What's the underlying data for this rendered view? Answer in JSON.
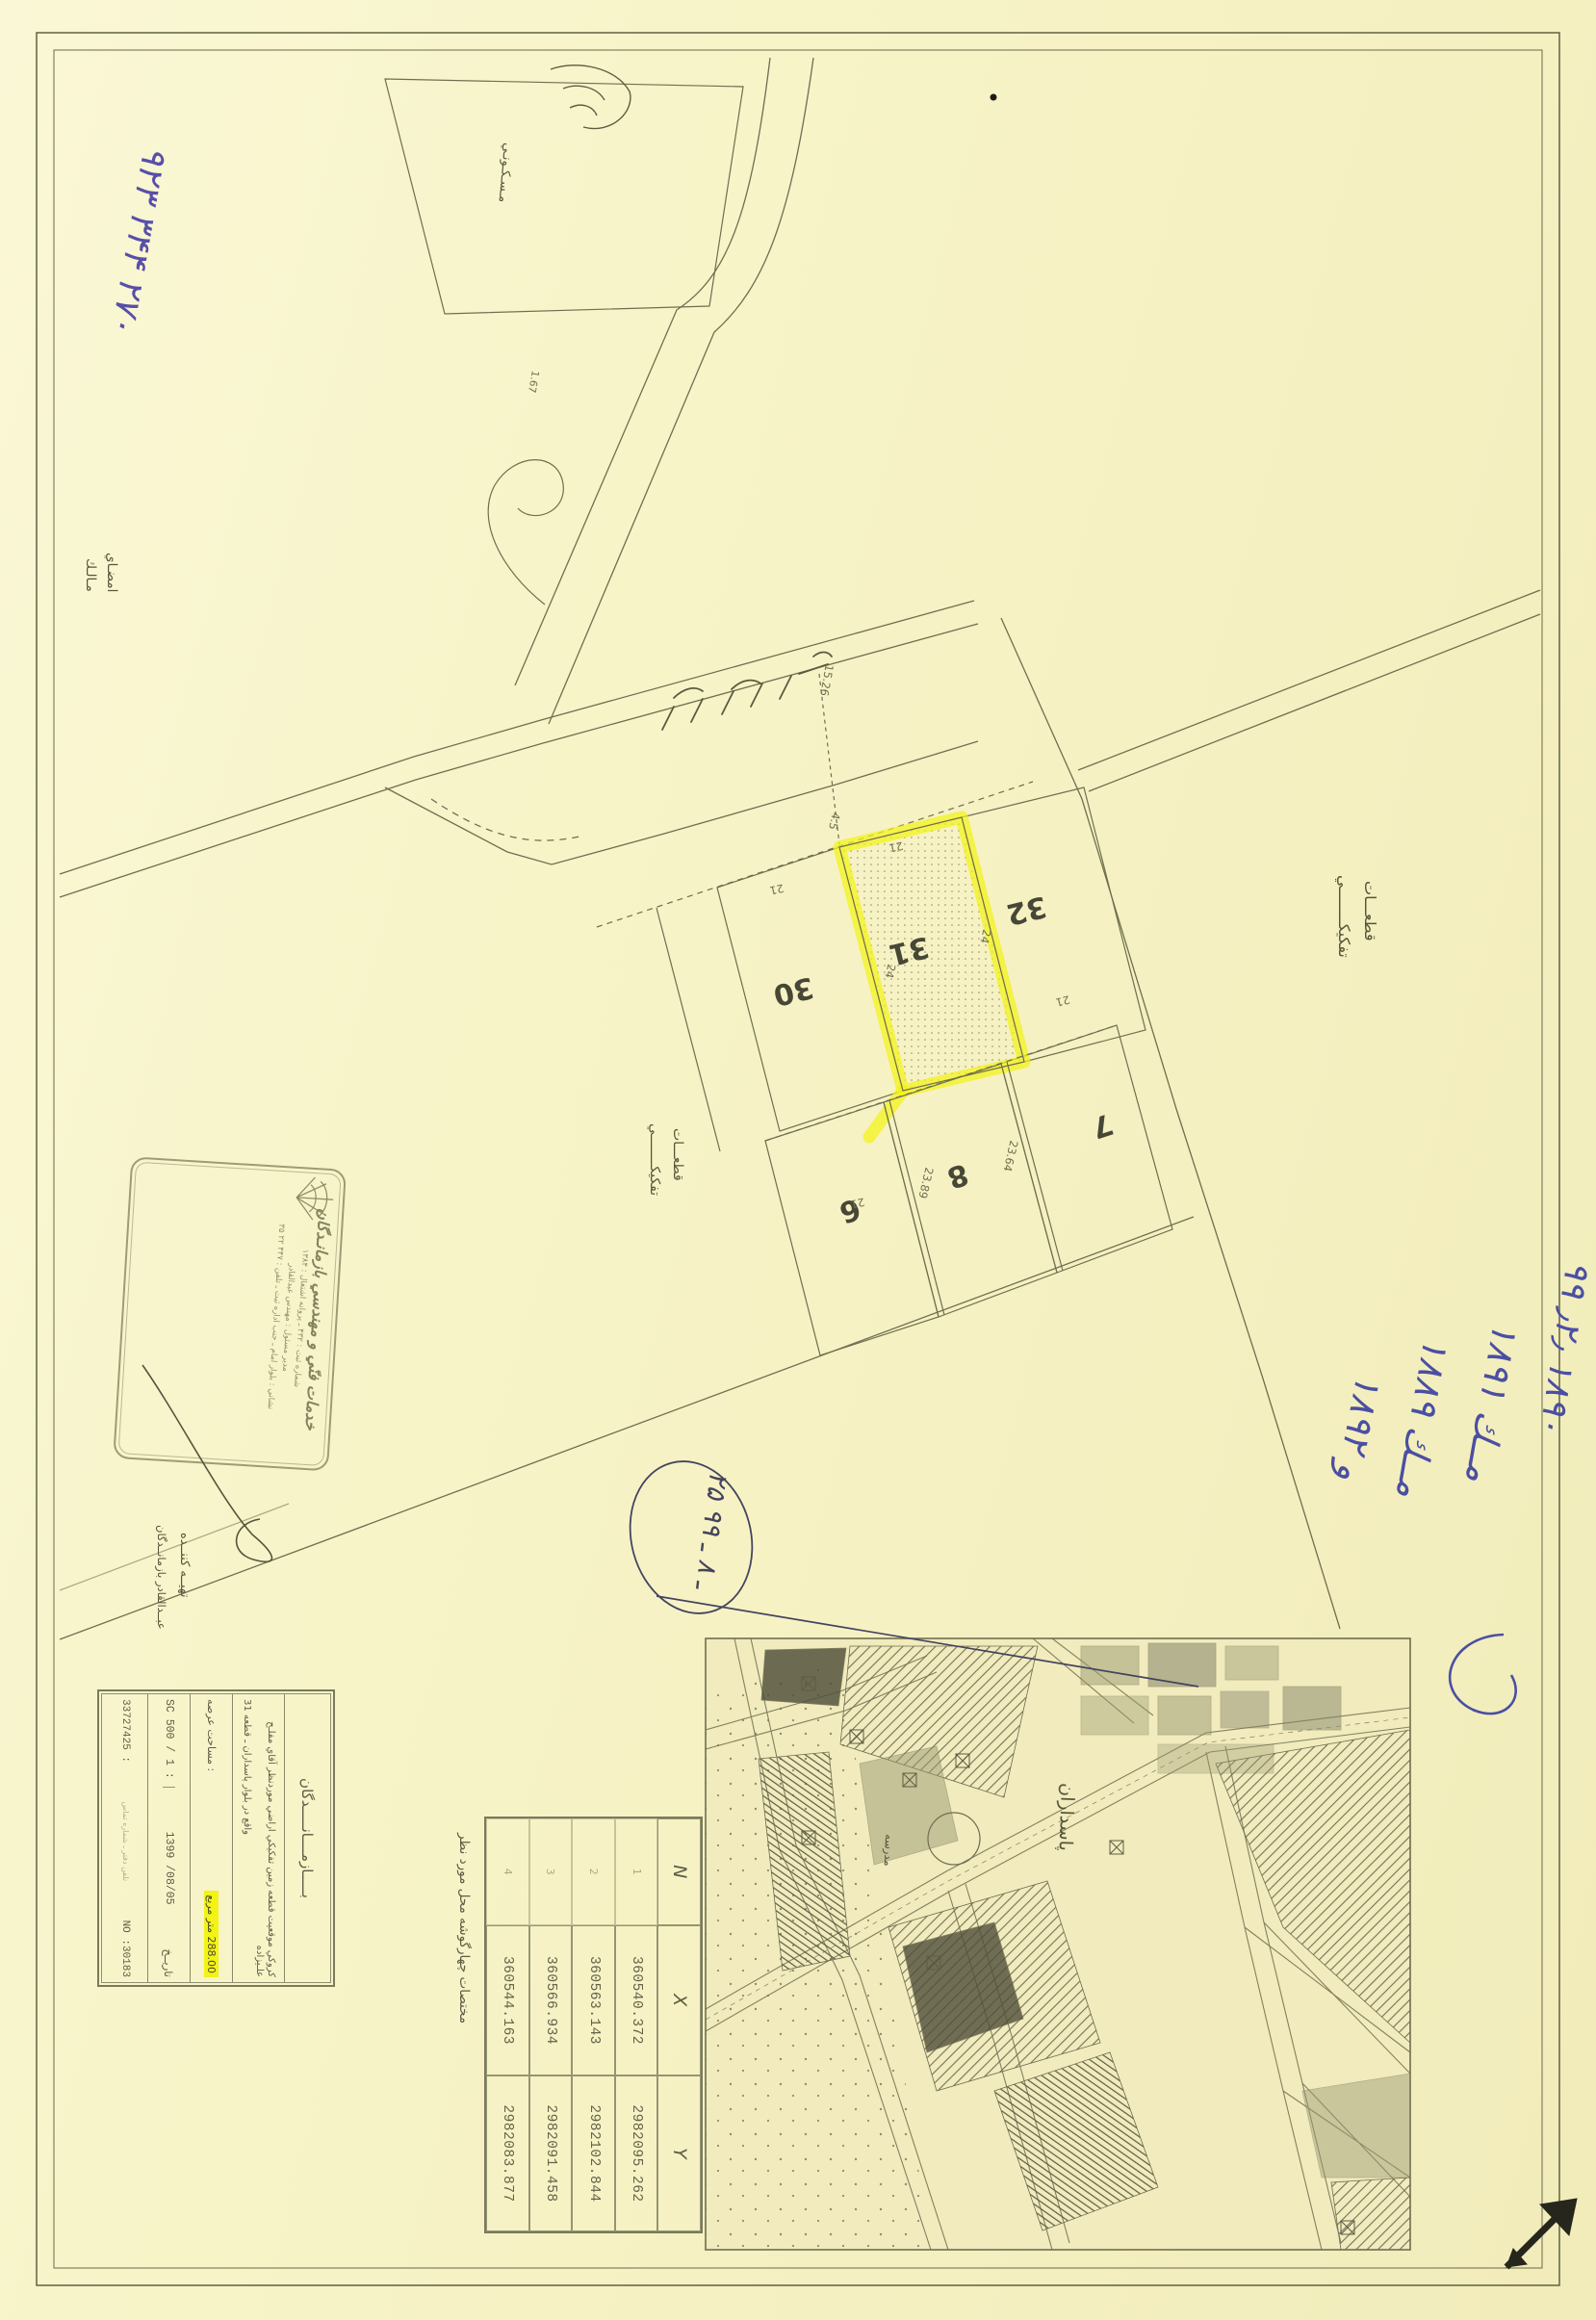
{
  "annotations": {
    "phone_number": "۹۲۳ ۳۴۴ ۲۷۰",
    "owner_signature": {
      "line1": "امضـاي",
      "line2": "مـالـك"
    },
    "residential": "مـسـكـونـي",
    "subdivision_1": {
      "line1": "قطعـــات",
      "line2": "تفكيكــــــــي"
    },
    "subdivision_2": {
      "line1": "قطعـــات",
      "line2": "تفكيكــــــــي"
    },
    "prepared_by": {
      "line1": "تهيــه كننــده",
      "line2": "عبــدالقادر بازمانــدگان"
    },
    "blue_notes": {
      "n1": "۹۹ ٫۲٫ ۱۸۹۰",
      "n2": "مــك ۱۸۹۱",
      "n3": "مــك ۱۸۸۹",
      "n4": "و ۱۸۹۲"
    },
    "circled_date": "۲۵ ـ ۸ ـ ۹۹"
  },
  "map": {
    "parcel_numbers": {
      "p30": "30",
      "p31": "31",
      "p32": "32",
      "p6": "6",
      "p8": "8",
      "p7": "7"
    },
    "dimensions": {
      "d1": "21",
      "d2": "21",
      "d3": "4.5",
      "d4": "24",
      "d5": "24",
      "d6": "21",
      "d7": "21",
      "d8": "15.26",
      "d9": "23.89",
      "d10": "23.64",
      "d11": "1.67"
    }
  },
  "stamp": {
    "title": "خدمات فنّي و مهندسي بازمانـدگان",
    "line2": "شماره ثبت : ۴۳۲ ـ پروانه اشتغال : ۱۳۸۴",
    "line3": "مدير مسئول : مهندس عبدالقادر",
    "line4": "نشاني : بلوار امام ـ جنب اداره ثبت ـ تلفن : ۴۴۷ ۲۲ ۳۵"
  },
  "info_table": {
    "header": "بـــــازمــــانـــــدگان",
    "desc_line1": "كروكي موقعيت قطعه زمين تفكيكي اراضي موردنظر آقاي مفلـح علـيزاده",
    "desc_line2": "واقع در بلوار پاسداران ـ قطعه 31",
    "area_label": "مساحت عرصه :",
    "area_value": "288.00 متر مربع",
    "scale_value": "SC 500 / 1 :",
    "date_value": "1399 /08/05",
    "date_label": "تاريــخ",
    "phone_row": "33727425 :",
    "small_note": "تلفن دفتر ـ شماره تماس",
    "sheet_no": "NO :30183"
  },
  "coord_table": {
    "caption": "مختصات چهارگوشه محل مورد نظر",
    "headers": {
      "n": "N",
      "x": "X",
      "y": "Y"
    },
    "rows": [
      {
        "n": "1",
        "x": "360540.372",
        "y": "2982095.262"
      },
      {
        "n": "2",
        "x": "360563.143",
        "y": "2982102.844"
      },
      {
        "n": "3",
        "x": "360566.934",
        "y": "2982091.458"
      },
      {
        "n": "4",
        "x": "360544.163",
        "y": "2982083.877"
      }
    ]
  },
  "inset_map": {
    "label_street": "پاسداران",
    "label_school": "مدرسه"
  }
}
